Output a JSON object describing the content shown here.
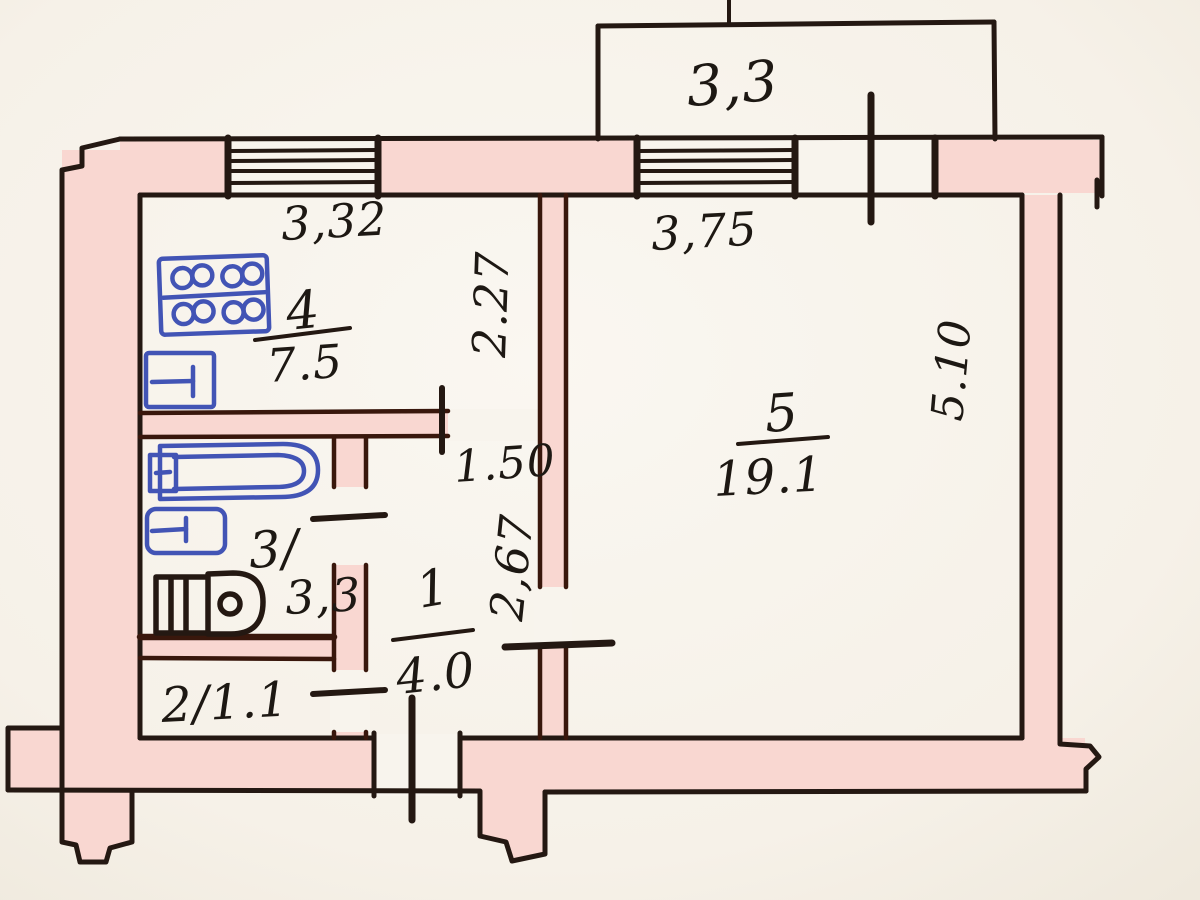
{
  "document": {
    "kind": "hand-drawn apartment floor plan",
    "style": "BTI technical passport sketch"
  },
  "palette": {
    "paper": "#f7f3ec",
    "wall_fill": "#f9d7d1",
    "ink": "#241812",
    "interior_wall_edge": "#39170c",
    "fixture_blue": "#4254b5"
  },
  "labels": {
    "balcony_width": "3,3",
    "kitchen_width": "3,32",
    "kitchen_depth": "2.27",
    "kitchen_number": "4",
    "kitchen_area": "7.5",
    "living_width": "3,75",
    "living_depth": "5.10",
    "living_number": "5",
    "living_area": "19.1",
    "hall_width": "1.50",
    "hall_depth": "2,67",
    "hall_number": "1",
    "hall_area": "4.0",
    "bath_number": "3/",
    "bath_area": "3,3",
    "wc_label": "2/1.1"
  },
  "fixtures": [
    "stove-icon",
    "kitchen-sink-icon",
    "bathtub-icon",
    "wash-basin-icon",
    "toilet-icon"
  ],
  "openings": [
    "kitchen-window",
    "living-room-window",
    "balcony-door",
    "kitchen-door",
    "bathroom-door",
    "wc-door",
    "living-room-door",
    "entrance-door"
  ]
}
